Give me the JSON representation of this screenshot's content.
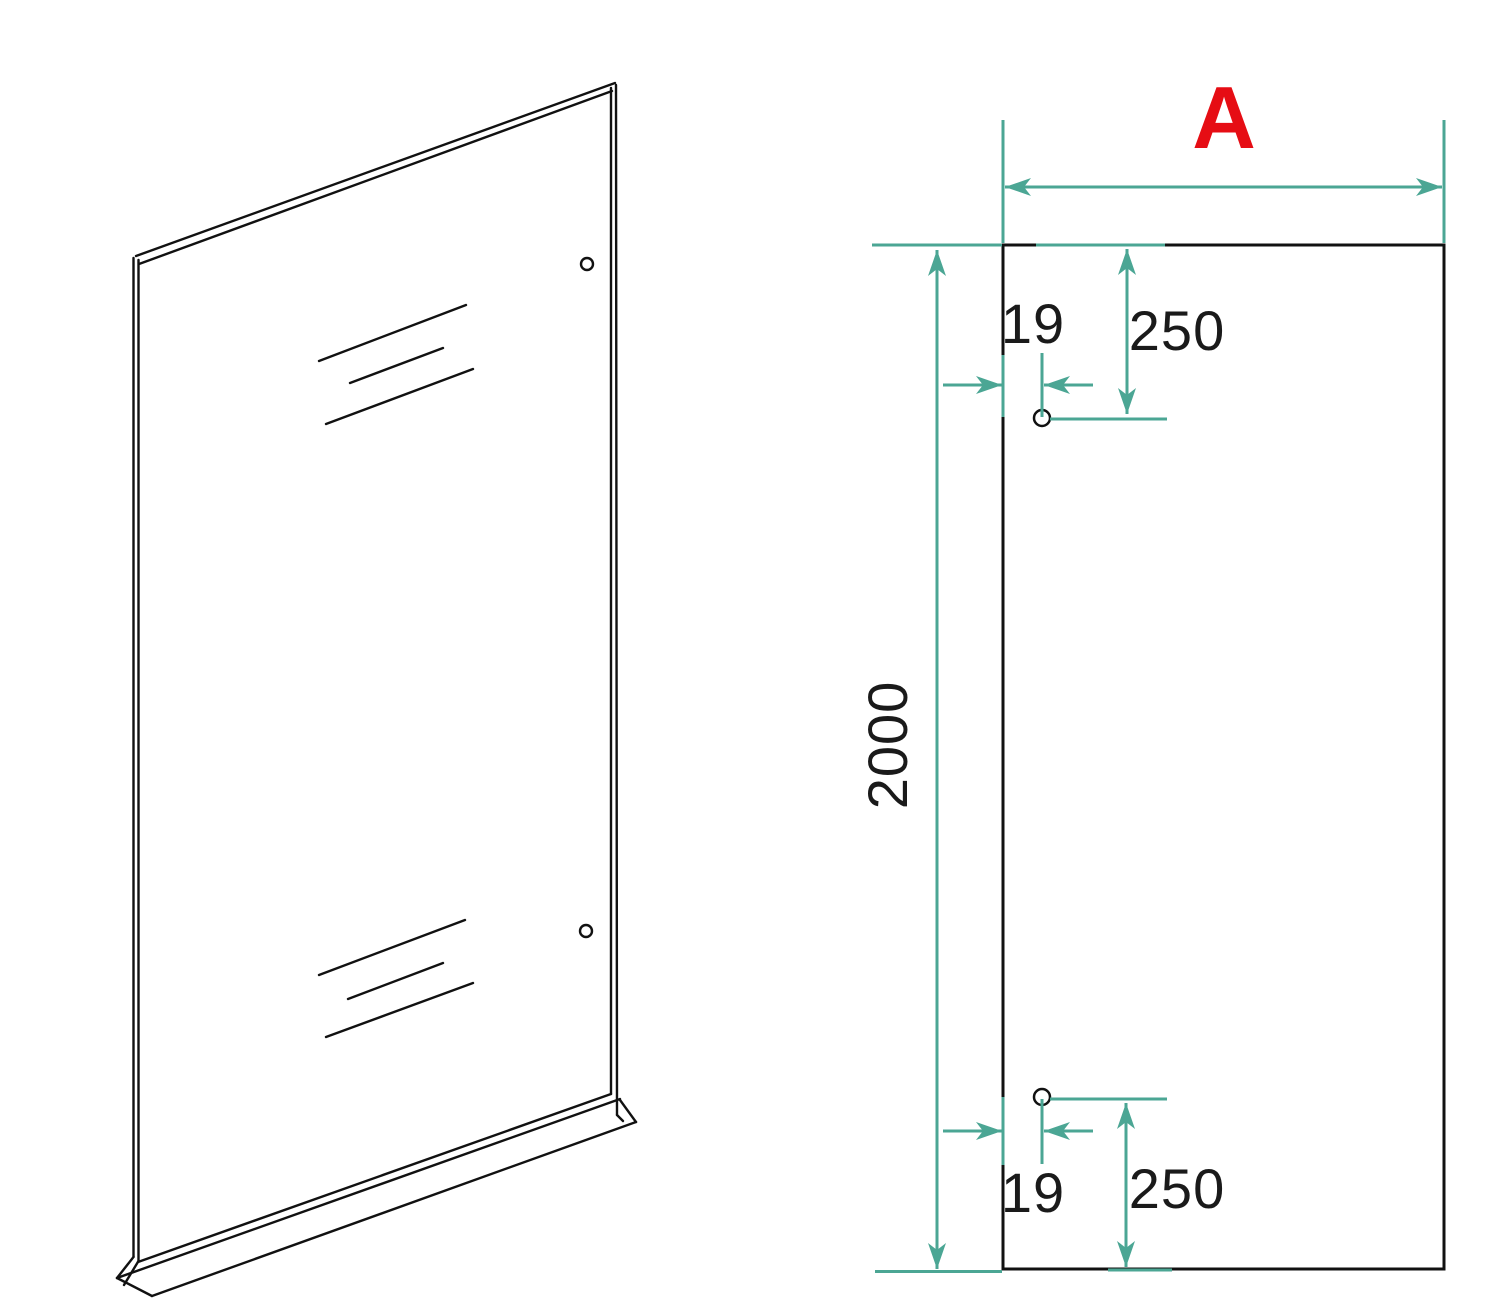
{
  "colors": {
    "dimension_lines": "#4BA694",
    "width_label": "#E60D14",
    "drawing_lines": "#111111",
    "background": "#FFFFFF"
  },
  "dimension_labels": {
    "width": "A",
    "height": "2000",
    "top": {
      "edge_to_hole": "19",
      "top_to_hole": "250"
    },
    "bottom": {
      "edge_to_hole": "19",
      "bottom_to_hole": "250"
    }
  }
}
